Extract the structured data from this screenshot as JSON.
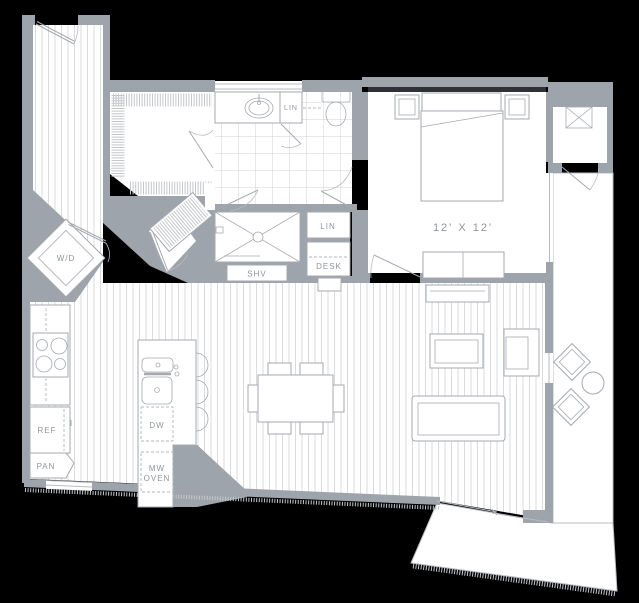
{
  "colors": {
    "bg": "#000000",
    "wall": "#9ea4ab",
    "room": "#ffffff",
    "line": "#a5aab0",
    "stripe": "#d9dbdd",
    "tile": "#ced2d5",
    "text": "#8f959b",
    "window": "#b7bbc0",
    "dark_band": "#2e3236"
  },
  "labels": {
    "washer_dryer": "W/D",
    "linen_bath": "LIN",
    "linen_bedroom": "LIN",
    "shelves": "SHV",
    "desk": "DESK",
    "bedroom_dimensions": "12' X 12'",
    "refrigerator": "REF",
    "pantry": "PAN",
    "dishwasher": "DW",
    "microwave_line1": "MW",
    "microwave_line2": "OVEN"
  }
}
